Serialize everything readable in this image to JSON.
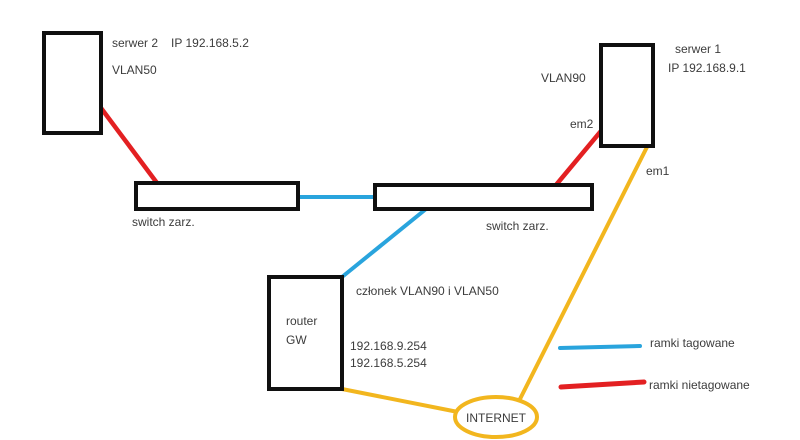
{
  "colors": {
    "tagged": "#29a4dd",
    "untagged": "#e32022",
    "internet_link": "#f2b61e",
    "node_border": "#101010",
    "text": "#3c3c3c"
  },
  "nodes": {
    "serwer2": {
      "name": "serwer 2",
      "ip": "IP 192.168.5.2",
      "vlan": "VLAN50"
    },
    "serwer1": {
      "name": "serwer 1",
      "ip": "IP 192.168.9.1",
      "vlan": "VLAN90",
      "port_top": "em2",
      "port_bottom": "em1"
    },
    "switch_left": {
      "label": "switch zarz."
    },
    "switch_right": {
      "label": "switch zarz."
    },
    "router": {
      "name": "router",
      "role": "GW",
      "note": "członek VLAN90 i VLAN50",
      "gateway_vlan90": "192.168.9.254",
      "gateway_vlan50": "192.168.5.254"
    },
    "internet": {
      "label": "INTERNET"
    }
  },
  "legend": {
    "tagged_label": "ramki tagowane",
    "untagged_label": "ramki nietagowane"
  }
}
